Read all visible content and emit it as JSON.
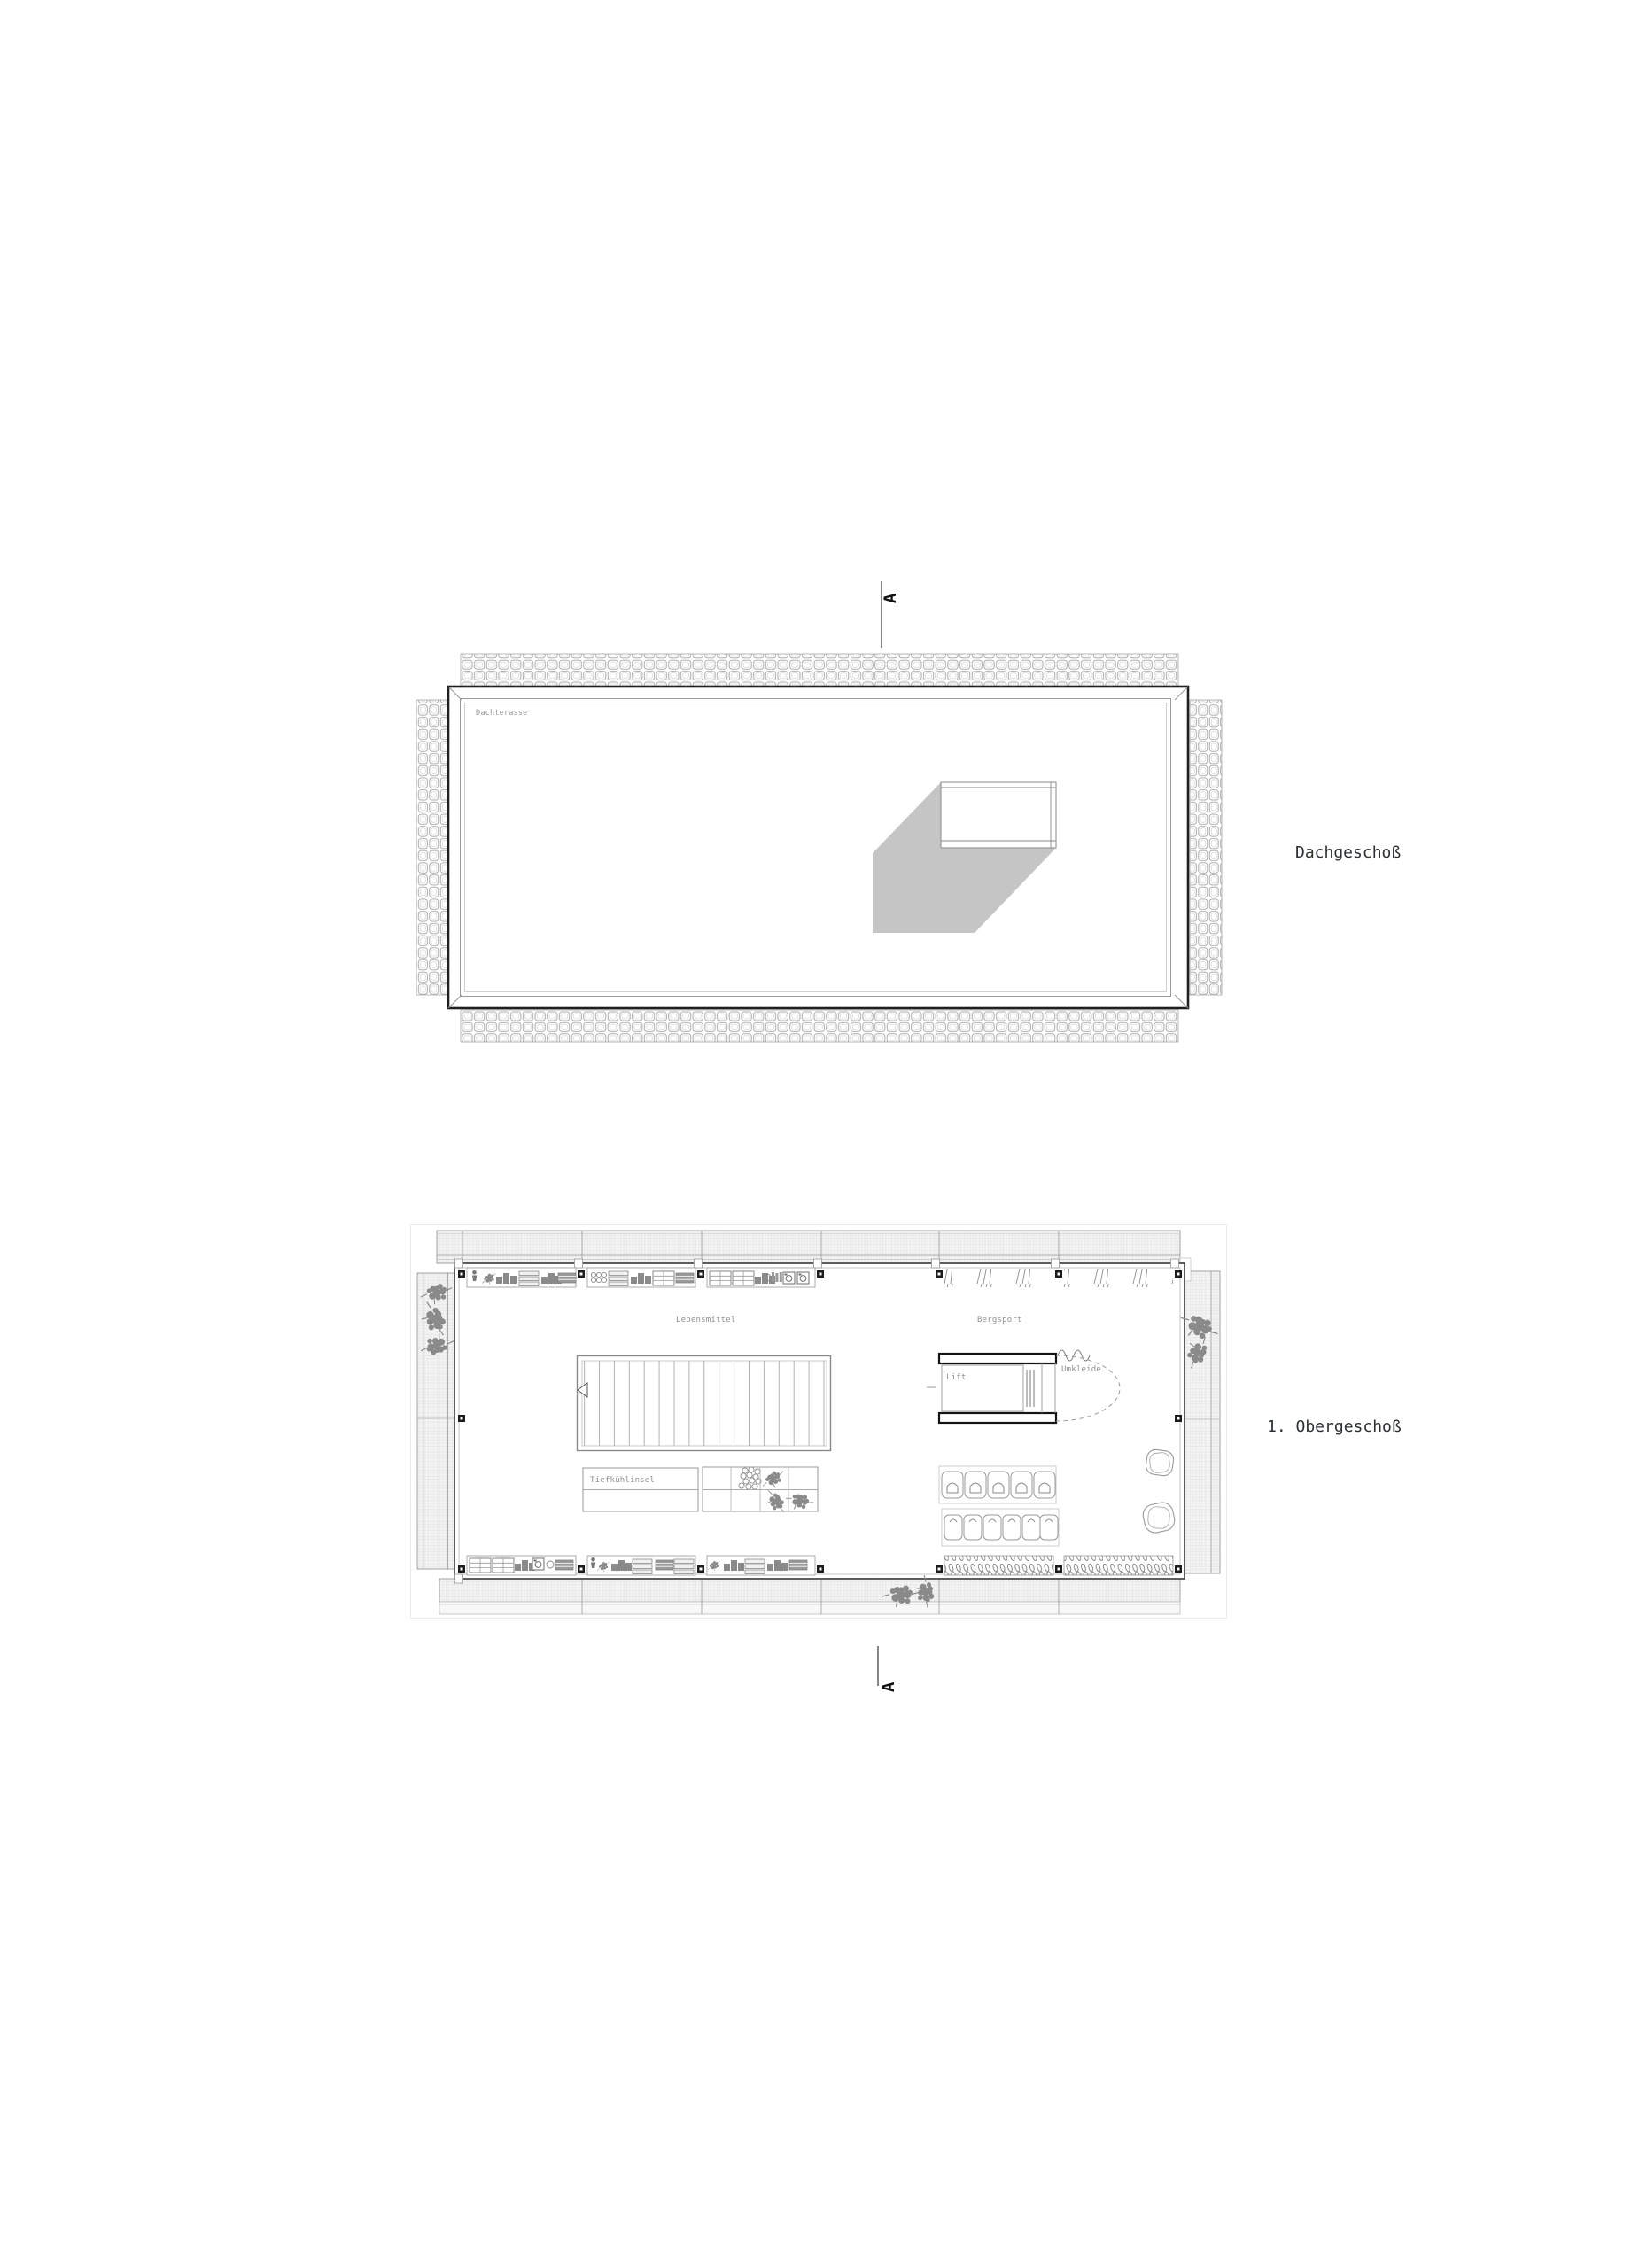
{
  "floors": {
    "roof": {
      "label": "Dachgeschoß",
      "room": "Dachterasse"
    },
    "first_upper": {
      "label": "1. Obergeschoß",
      "zones": {
        "groceries": "Lebensmittel",
        "mountain_sports": "Bergsport",
        "freezer_island": "Tiefkühlinsel",
        "lift": "Lift",
        "changing_room": "Umkleide"
      }
    }
  },
  "section_markers": {
    "top": "A",
    "bottom": "A"
  },
  "icon_names": [
    "plant-cluster-icon",
    "produce-bin-icon",
    "shoe-pair-icon",
    "ski-rack-icon",
    "washer-appliance-icon",
    "wc-stall-icon",
    "shelf-unit-icon",
    "box-stack-icon",
    "stair-icon",
    "chair-icon"
  ],
  "colors": {
    "wall_dark": "#1f1f1f",
    "wall_mid": "#4d4d4d",
    "line_mid": "#8a8a8a",
    "line_light": "#c9c9c9",
    "shadow": "#c5c5c5",
    "small_text": "#8f8f8f",
    "title_text": "#2c2f33",
    "hatch_bg": "#f4f4f4"
  }
}
